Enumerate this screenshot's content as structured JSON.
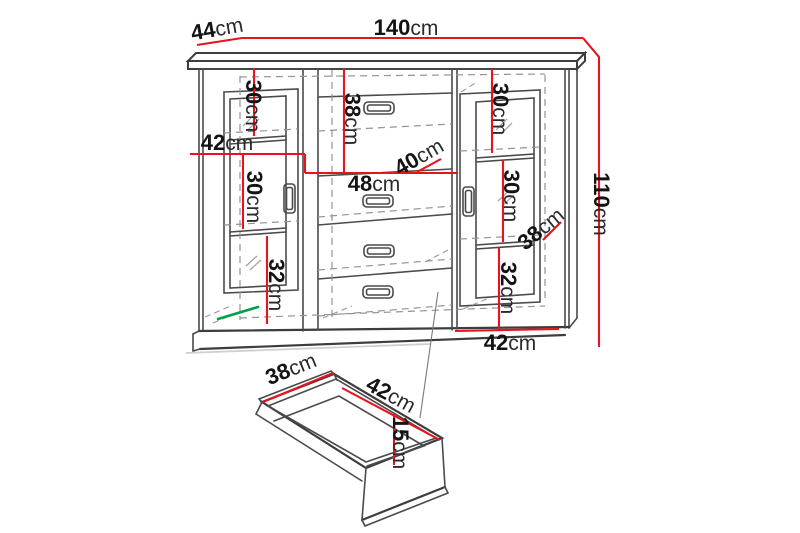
{
  "diagram": {
    "unit_label": "cm",
    "colors": {
      "dimension_red": "#e8131d",
      "highlight_green": "#00a04a",
      "outline_gray": "#4a4a4a"
    },
    "cabinet": {
      "width": {
        "value": "140",
        "unit": "cm"
      },
      "depth": {
        "value": "44",
        "unit": "cm"
      },
      "height": {
        "value": "110",
        "unit": "cm"
      },
      "left_section": {
        "top_compartment_height": {
          "value": "30",
          "unit": "cm"
        },
        "door_width": {
          "value": "42",
          "unit": "cm"
        },
        "middle_compartment_height": {
          "value": "30",
          "unit": "cm"
        },
        "bottom_compartment_height": {
          "value": "32",
          "unit": "cm"
        }
      },
      "center_section": {
        "top_drawer_height": {
          "value": "38",
          "unit": "cm"
        },
        "inner_depth": {
          "value": "40",
          "unit": "cm"
        },
        "drawer_width": {
          "value": "48",
          "unit": "cm"
        }
      },
      "right_section": {
        "top_compartment_height": {
          "value": "30",
          "unit": "cm"
        },
        "middle_compartment_height": {
          "value": "30",
          "unit": "cm"
        },
        "inner_depth": {
          "value": "38",
          "unit": "cm"
        },
        "bottom_compartment_height": {
          "value": "32",
          "unit": "cm"
        },
        "door_width": {
          "value": "42",
          "unit": "cm"
        }
      }
    },
    "drawer": {
      "depth": {
        "value": "38",
        "unit": "cm"
      },
      "width": {
        "value": "42",
        "unit": "cm"
      },
      "height": {
        "value": "15",
        "unit": "cm"
      }
    }
  }
}
